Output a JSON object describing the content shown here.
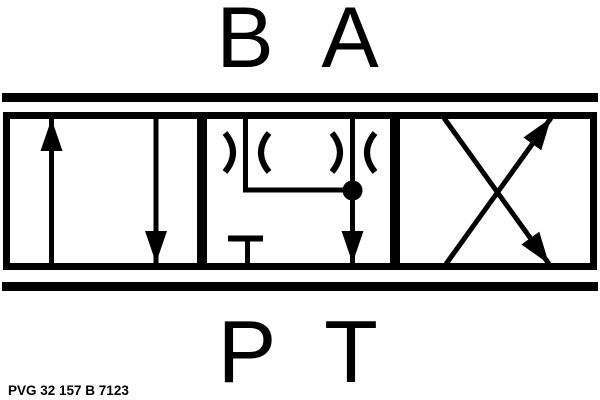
{
  "schematic": {
    "kind": "hydraulic-directional-valve-symbol",
    "top_ports": {
      "b": "B",
      "a": "A"
    },
    "bottom_ports": {
      "p": "P",
      "t": "T"
    },
    "model_code": "PVG 32 157 B 7123",
    "colors": {
      "line": "#000000",
      "background": "#ffffff"
    }
  }
}
